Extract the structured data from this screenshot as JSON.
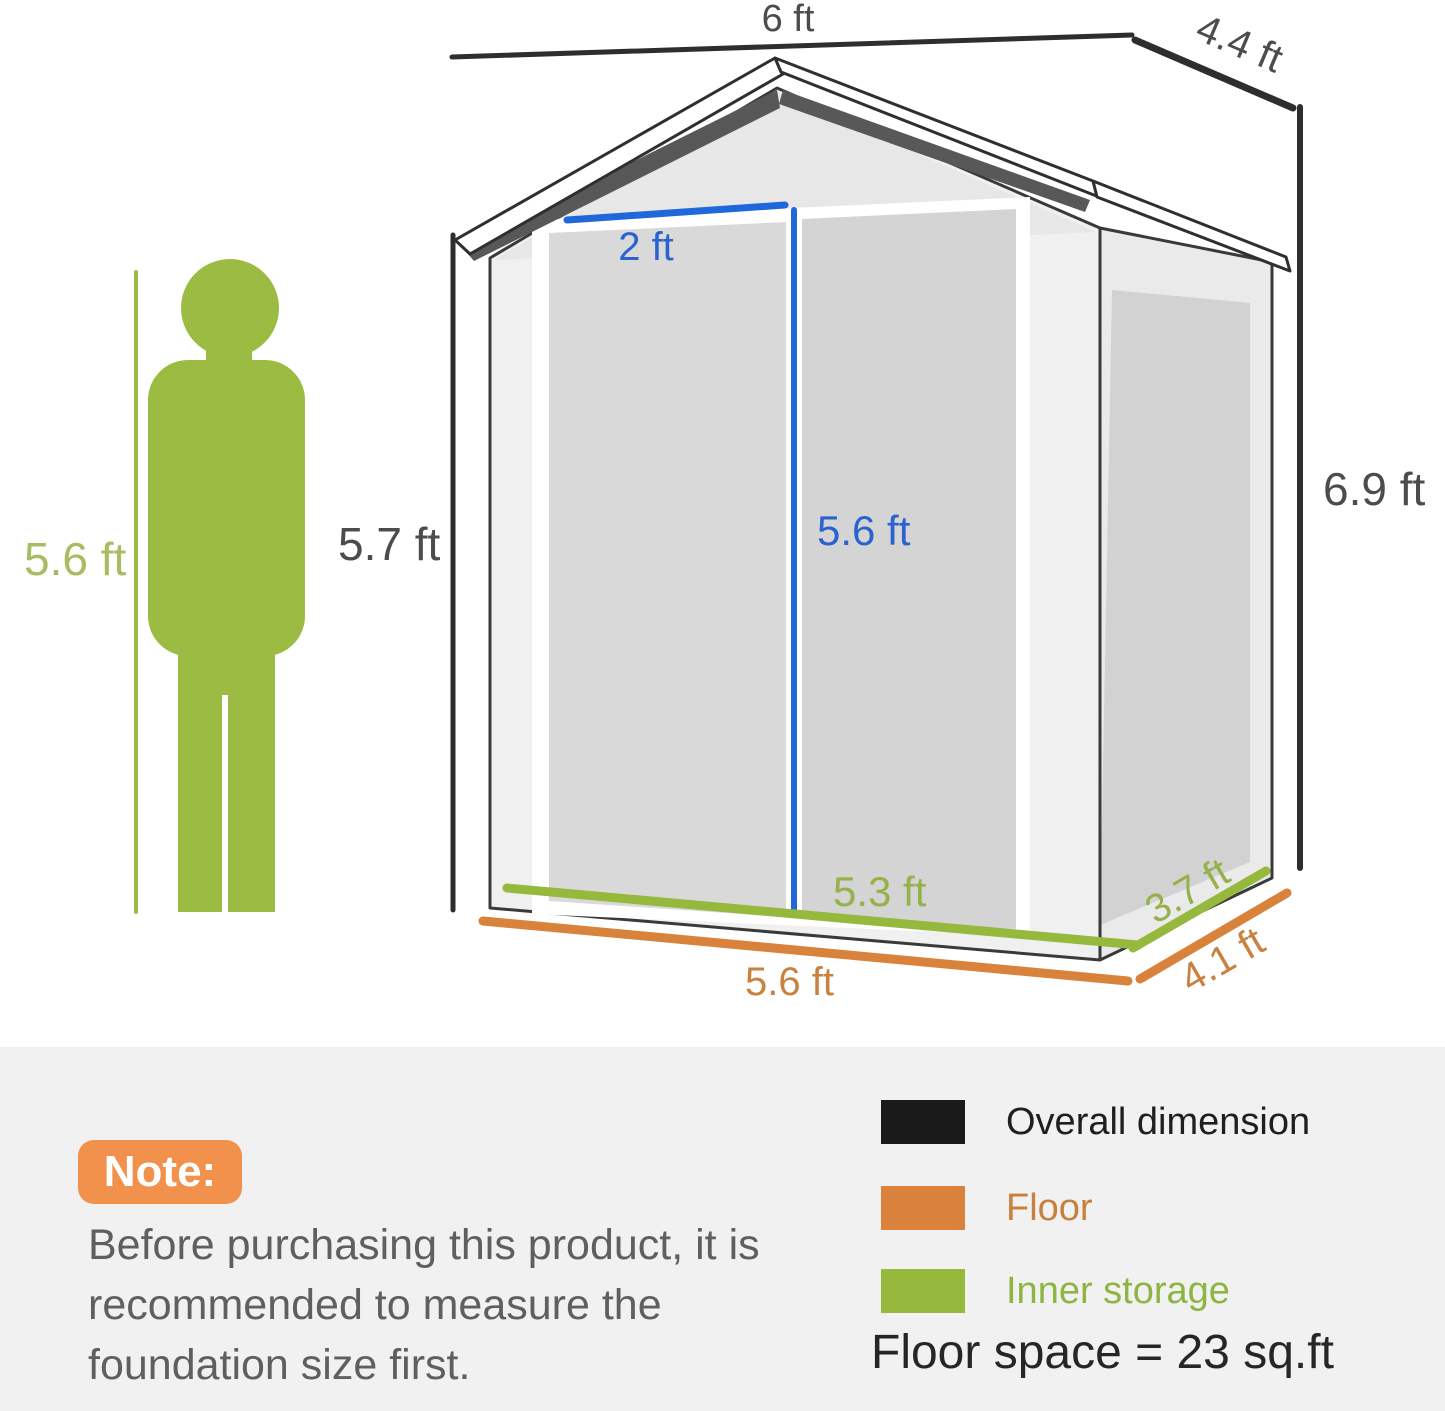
{
  "dim": {
    "overall_width": "6 ft",
    "overall_depth": "4.4 ft",
    "overall_height": "6.9 ft",
    "eave_height": "5.7 ft",
    "person_height": "5.6 ft",
    "door_width": "2 ft",
    "door_height": "5.6 ft",
    "inner_width": "5.3 ft",
    "inner_depth": "3.7 ft",
    "floor_width": "5.6 ft",
    "floor_depth": "4.1 ft"
  },
  "legend": {
    "items": [
      {
        "label": "Overall dimension",
        "color": "#1a1a1a"
      },
      {
        "label": "Floor",
        "color": "#d9823b"
      },
      {
        "label": "Inner storage",
        "color": "#96b83c"
      }
    ],
    "floor_space": "Floor space = 23 sq.ft"
  },
  "note": {
    "title": "Note:",
    "body": "Before purchasing this product, it is recommended to measure the foundation size first."
  },
  "colors": {
    "overall_dimension_black": "#1a1a1a",
    "floor_orange": "#d9823b",
    "inner_storage_green": "#96b83c",
    "door_blue": "#1e68db",
    "person_green": "#9cbb42",
    "note_badge_orange": "#f2914b"
  }
}
